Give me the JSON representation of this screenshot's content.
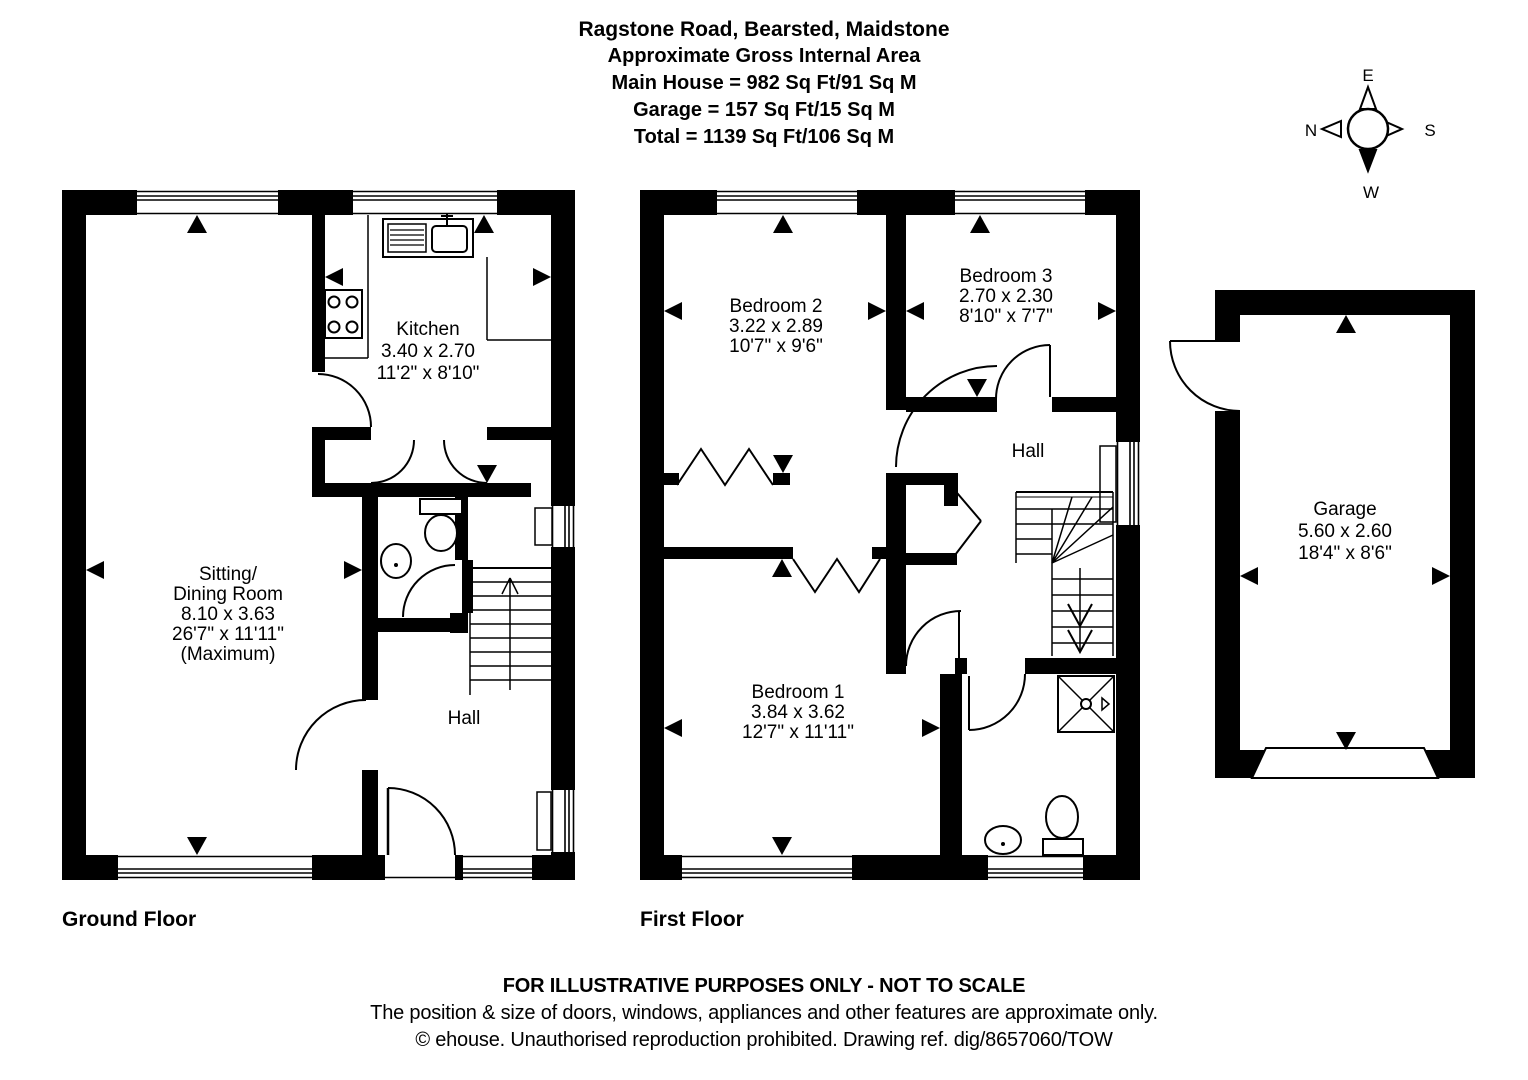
{
  "header": {
    "title": "Ragstone Road, Bearsted, Maidstone",
    "subtitle": "Approximate Gross Internal Area",
    "main_house": "Main House = 982 Sq Ft/91 Sq M",
    "garage_area": "Garage = 157 Sq Ft/15 Sq M",
    "total_area": "Total = 1139 Sq Ft/106 Sq M"
  },
  "compass": {
    "north": "N",
    "east": "E",
    "south": "S",
    "west": "W"
  },
  "floors": {
    "ground": {
      "label": "Ground Floor"
    },
    "first": {
      "label": "First Floor"
    }
  },
  "rooms": {
    "kitchen": {
      "name": "Kitchen",
      "metric": "3.40 x 2.70",
      "imperial": "11'2\" x 8'10\""
    },
    "sitting": {
      "name": "Sitting/",
      "name2": "Dining Room",
      "metric": "8.10 x 3.63",
      "imperial": "26'7\" x 11'11\"",
      "note": "(Maximum)"
    },
    "hall_ground": {
      "name": "Hall"
    },
    "bedroom2": {
      "name": "Bedroom 2",
      "metric": "3.22 x 2.89",
      "imperial": "10'7\" x 9'6\""
    },
    "bedroom3": {
      "name": "Bedroom 3",
      "metric": "2.70 x 2.30",
      "imperial": "8'10\" x 7'7\""
    },
    "hall_first": {
      "name": "Hall"
    },
    "bedroom1": {
      "name": "Bedroom 1",
      "metric": "3.84 x 3.62",
      "imperial": "12'7\" x 11'11\""
    },
    "garage": {
      "name": "Garage",
      "metric": "5.60 x 2.60",
      "imperial": "18'4\" x 8'6\""
    }
  },
  "footer": {
    "line1": "FOR ILLUSTRATIVE PURPOSES ONLY - NOT TO SCALE",
    "line2": "The position & size of doors, windows, appliances and other features are approximate only.",
    "line3": "© ehouse. Unauthorised reproduction prohibited. Drawing ref. dig/8657060/TOW"
  },
  "colors": {
    "ink": "#000000",
    "paper": "#ffffff"
  }
}
